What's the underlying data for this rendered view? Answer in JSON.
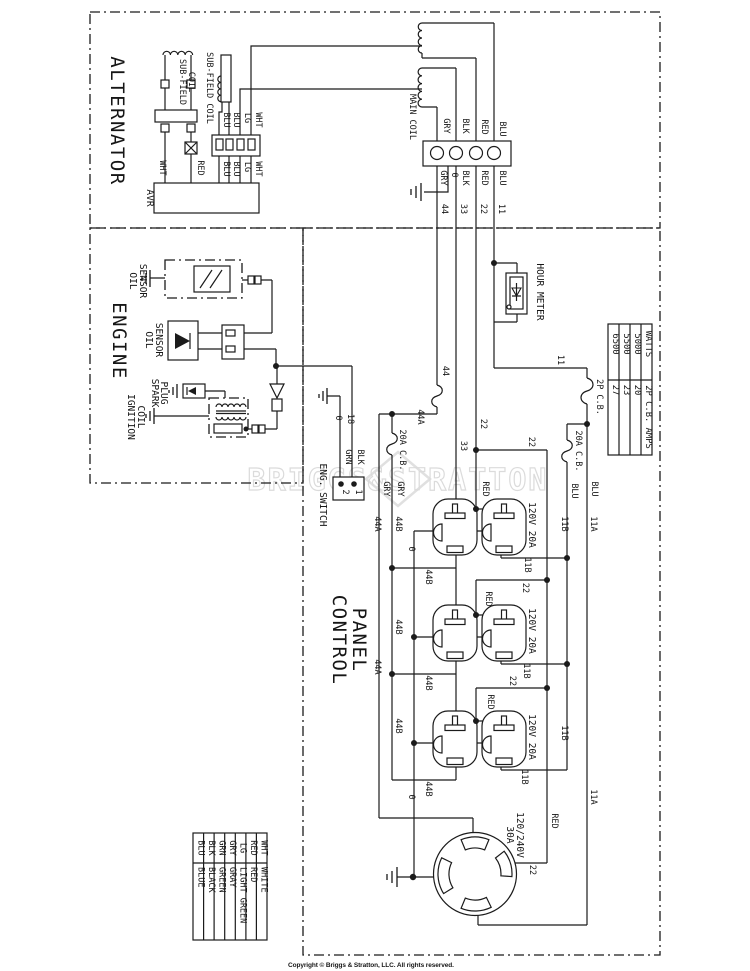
{
  "titles": {
    "alternator": "ALTERNATOR",
    "engine": "ENGINE",
    "control_1": "CONTROL",
    "control_2": "PANEL"
  },
  "alternator": {
    "avr": "AVR",
    "sub_field_a": "SUB-FIELD",
    "sub_field_b": "COIL",
    "sub_field_2": "SUB-FIELD COIL",
    "main_coil": "MAIN COIL"
  },
  "engine": {
    "oil": "OIL",
    "sensor": "SENSOR",
    "spark": "SPARK",
    "plug": "PLUG",
    "ignition": "IGNITION",
    "coil": "COIL"
  },
  "switch": {
    "label": "ENG. SWITCH",
    "t1": "1",
    "t2": "2"
  },
  "panel": {
    "hour_meter": "HOUR METER",
    "cb_2p": "2P C.B.",
    "cb_20a": "20A C.B.",
    "outlet_label": "120V 20A",
    "twist_v": "120/240V",
    "twist_a": "30A"
  },
  "wires": {
    "wht": "WHT",
    "red": "RED",
    "lg": "LG",
    "blu": "BLU",
    "blk": "BLK",
    "gry": "GRY",
    "grn": "GRN",
    "n0": "0",
    "n11": "11",
    "n22": "22",
    "n33": "33",
    "n44": "44",
    "n18": "18",
    "n44a": "44A",
    "n44b": "44B",
    "n11a": "11A",
    "n11b": "11B"
  },
  "table": {
    "col_watts": "WATTS",
    "col_amps": "2P C.B. AMPS",
    "watts": [
      "5000",
      "5500",
      "6500"
    ],
    "amps": [
      "20",
      "23",
      "27"
    ]
  },
  "legend": [
    {
      "abbr": "BLU",
      "name": "BLUE"
    },
    {
      "abbr": "BLK",
      "name": "BLACK"
    },
    {
      "abbr": "GRN",
      "name": "GREEN"
    },
    {
      "abbr": "GRY",
      "name": "GRAY"
    },
    {
      "abbr": "LG",
      "name": "LIGHT GREEN"
    },
    {
      "abbr": "RED",
      "name": "RED"
    },
    {
      "abbr": "WHT",
      "name": "WHITE"
    }
  ],
  "watermark": "BRIGGS&STRATTON",
  "footer": {
    "copyright": "Copyright © Briggs & Stratton, LLC. All rights reserved."
  },
  "colors": {
    "line": "#1b1b1b",
    "watermark": "#cfcfcf",
    "background": "#ffffff"
  }
}
